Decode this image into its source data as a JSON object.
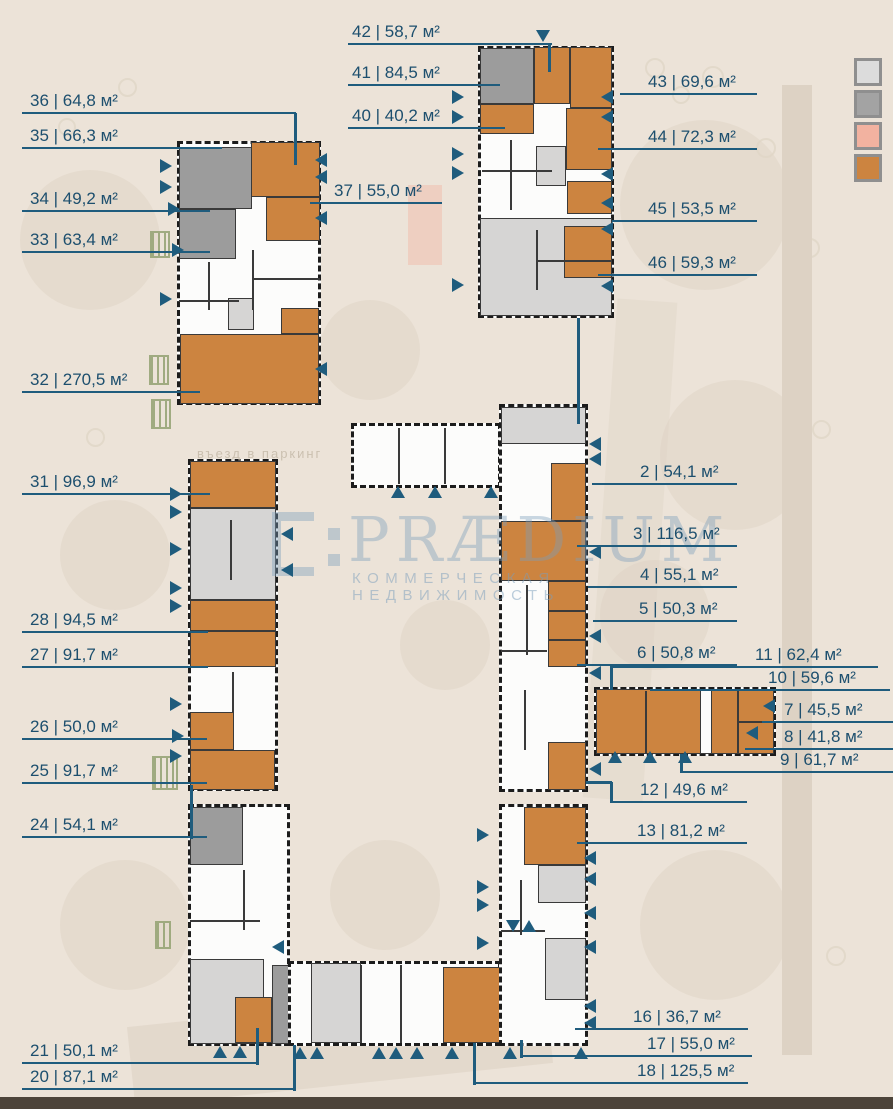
{
  "palette": {
    "bg": "#ece3d8",
    "blob": "#e0d6c7",
    "strip": "#ddd2c4",
    "dark": "#4d443a",
    "teal": "#1f5c7d",
    "label": "#1d4f6e",
    "orange": "#cc8440",
    "dgray": "#9c9c9c",
    "lgray": "#d6d5d4",
    "white": "#fcfcfb",
    "wall": "#3a3a3a",
    "green": "#93a272",
    "pink": "#f2b2a0",
    "wm": "rgba(122,158,188,0.40)",
    "wm2": "rgba(122,158,188,0.50)"
  },
  "watermark": {
    "brand": "PRÆDIUM",
    "tagline": "КОММЕРЧЕСКАЯ НЕДВИЖИМОСТЬ"
  },
  "plan": {
    "parking_note": "въезд в паркинг"
  },
  "legend": {
    "swatches": [
      {
        "name": "white-unit",
        "style": "background:#dcdcdc"
      },
      {
        "name": "gray-unit",
        "style": "background:#a3a3a3"
      },
      {
        "name": "pink-unit",
        "style": "background:#f2b2a0"
      },
      {
        "name": "orange-unit",
        "style": "background:#cc8440"
      }
    ]
  },
  "labels": {
    "u36": {
      "text": "36 | 64,8 м²"
    },
    "u35": {
      "text": "35 | 66,3 м²"
    },
    "u34": {
      "text": "34 | 49,2 м²"
    },
    "u33": {
      "text": "33 | 63,4 м²"
    },
    "u32": {
      "text": "32 | 270,5 м²"
    },
    "u31": {
      "text": "31 | 96,9 м²"
    },
    "u28": {
      "text": "28 | 94,5 м²"
    },
    "u27": {
      "text": "27 | 91,7 м²"
    },
    "u26": {
      "text": "26 | 50,0 м²"
    },
    "u25": {
      "text": "25 | 91,7 м²"
    },
    "u24": {
      "text": "24 | 54,1 м²"
    },
    "u21": {
      "text": "21 | 50,1 м²"
    },
    "u20": {
      "text": "20 | 87,1 м²"
    },
    "u42": {
      "text": "42 | 58,7 м²"
    },
    "u41": {
      "text": "41 | 84,5 м²"
    },
    "u40": {
      "text": "40 | 40,2 м²"
    },
    "u37": {
      "text": "37 | 55,0 м²"
    },
    "u43": {
      "text": "43 | 69,6 м²"
    },
    "u44": {
      "text": "44 | 72,3 м²"
    },
    "u45": {
      "text": "45 | 53,5 м²"
    },
    "u46": {
      "text": "46 | 59,3 м²"
    },
    "u2": {
      "text": "2 | 54,1 м²"
    },
    "u3": {
      "text": "3 | 116,5 м²"
    },
    "u4": {
      "text": "4 | 55,1 м²"
    },
    "u5": {
      "text": "5 | 50,3 м²"
    },
    "u6": {
      "text": "6 | 50,8 м²"
    },
    "u11": {
      "text": "11 | 62,4 м²"
    },
    "u10": {
      "text": "10 | 59,6 м²"
    },
    "u7": {
      "text": "7 | 45,5 м²"
    },
    "u8": {
      "text": "8 | 41,8 м²"
    },
    "u9": {
      "text": "9 | 61,7 м²"
    },
    "u12": {
      "text": "12 | 49,6 м²"
    },
    "u13": {
      "text": "13 | 81,2 м²"
    },
    "u16": {
      "text": "16 | 36,7 м²"
    },
    "u17": {
      "text": "17 | 55,0 м²"
    },
    "u18": {
      "text": "18 | 125,5 м²"
    }
  }
}
